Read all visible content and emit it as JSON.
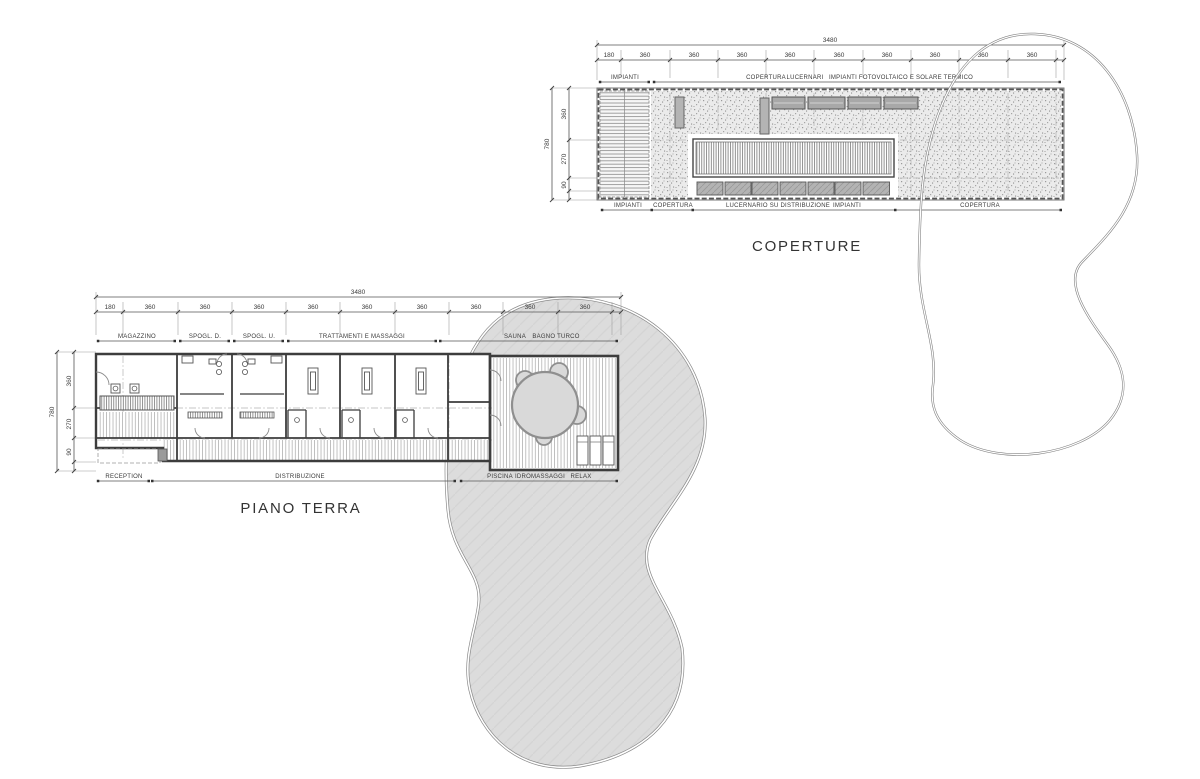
{
  "coperture": {
    "title": "COPERTURE",
    "dim_total": "3480",
    "dim_height_total": "780",
    "dims_top": [
      "180",
      "360",
      "360",
      "360",
      "360",
      "360",
      "360",
      "360",
      "360",
      "360"
    ],
    "dims_left": [
      "360",
      "270",
      "90"
    ],
    "labels_top": [
      "IMPIANTI",
      "COPERTURA",
      "LUCERNARI",
      "IMPIANTI",
      "FOTOVOLTAICO E SOLARE TERMICO"
    ],
    "labels_bottom": [
      "IMPIANTI",
      "COPERTURA",
      "LUCERNARIO SU DISTRIBUZIONE",
      "IMPIANTI",
      "COPERTURA"
    ]
  },
  "piano_terra": {
    "title": "PIANO TERRA",
    "dim_total": "3480",
    "dim_height_total": "780",
    "dims_top": [
      "180",
      "360",
      "360",
      "360",
      "360",
      "360",
      "360",
      "360",
      "360",
      "360"
    ],
    "dims_left": [
      "360",
      "270",
      "90"
    ],
    "labels_top": [
      "MAGAZZINO",
      "SPOGL. D.",
      "SPOGL. U.",
      "TRATTAMENTI E MASSAGGI",
      "SAUNA",
      "BAGNO TURCO"
    ],
    "labels_bottom": [
      "RECEPTION",
      "DISTRIBUZIONE",
      "PISCINA",
      "IDROMASSAGGI",
      "RELAX"
    ]
  },
  "colors": {
    "drawing_line": "#555555",
    "wall": "#3d3d3d",
    "pool_fill": "#d9d9d9",
    "blob_fill": "#dcdcdc",
    "panel_fill": "#b0b0b0"
  }
}
